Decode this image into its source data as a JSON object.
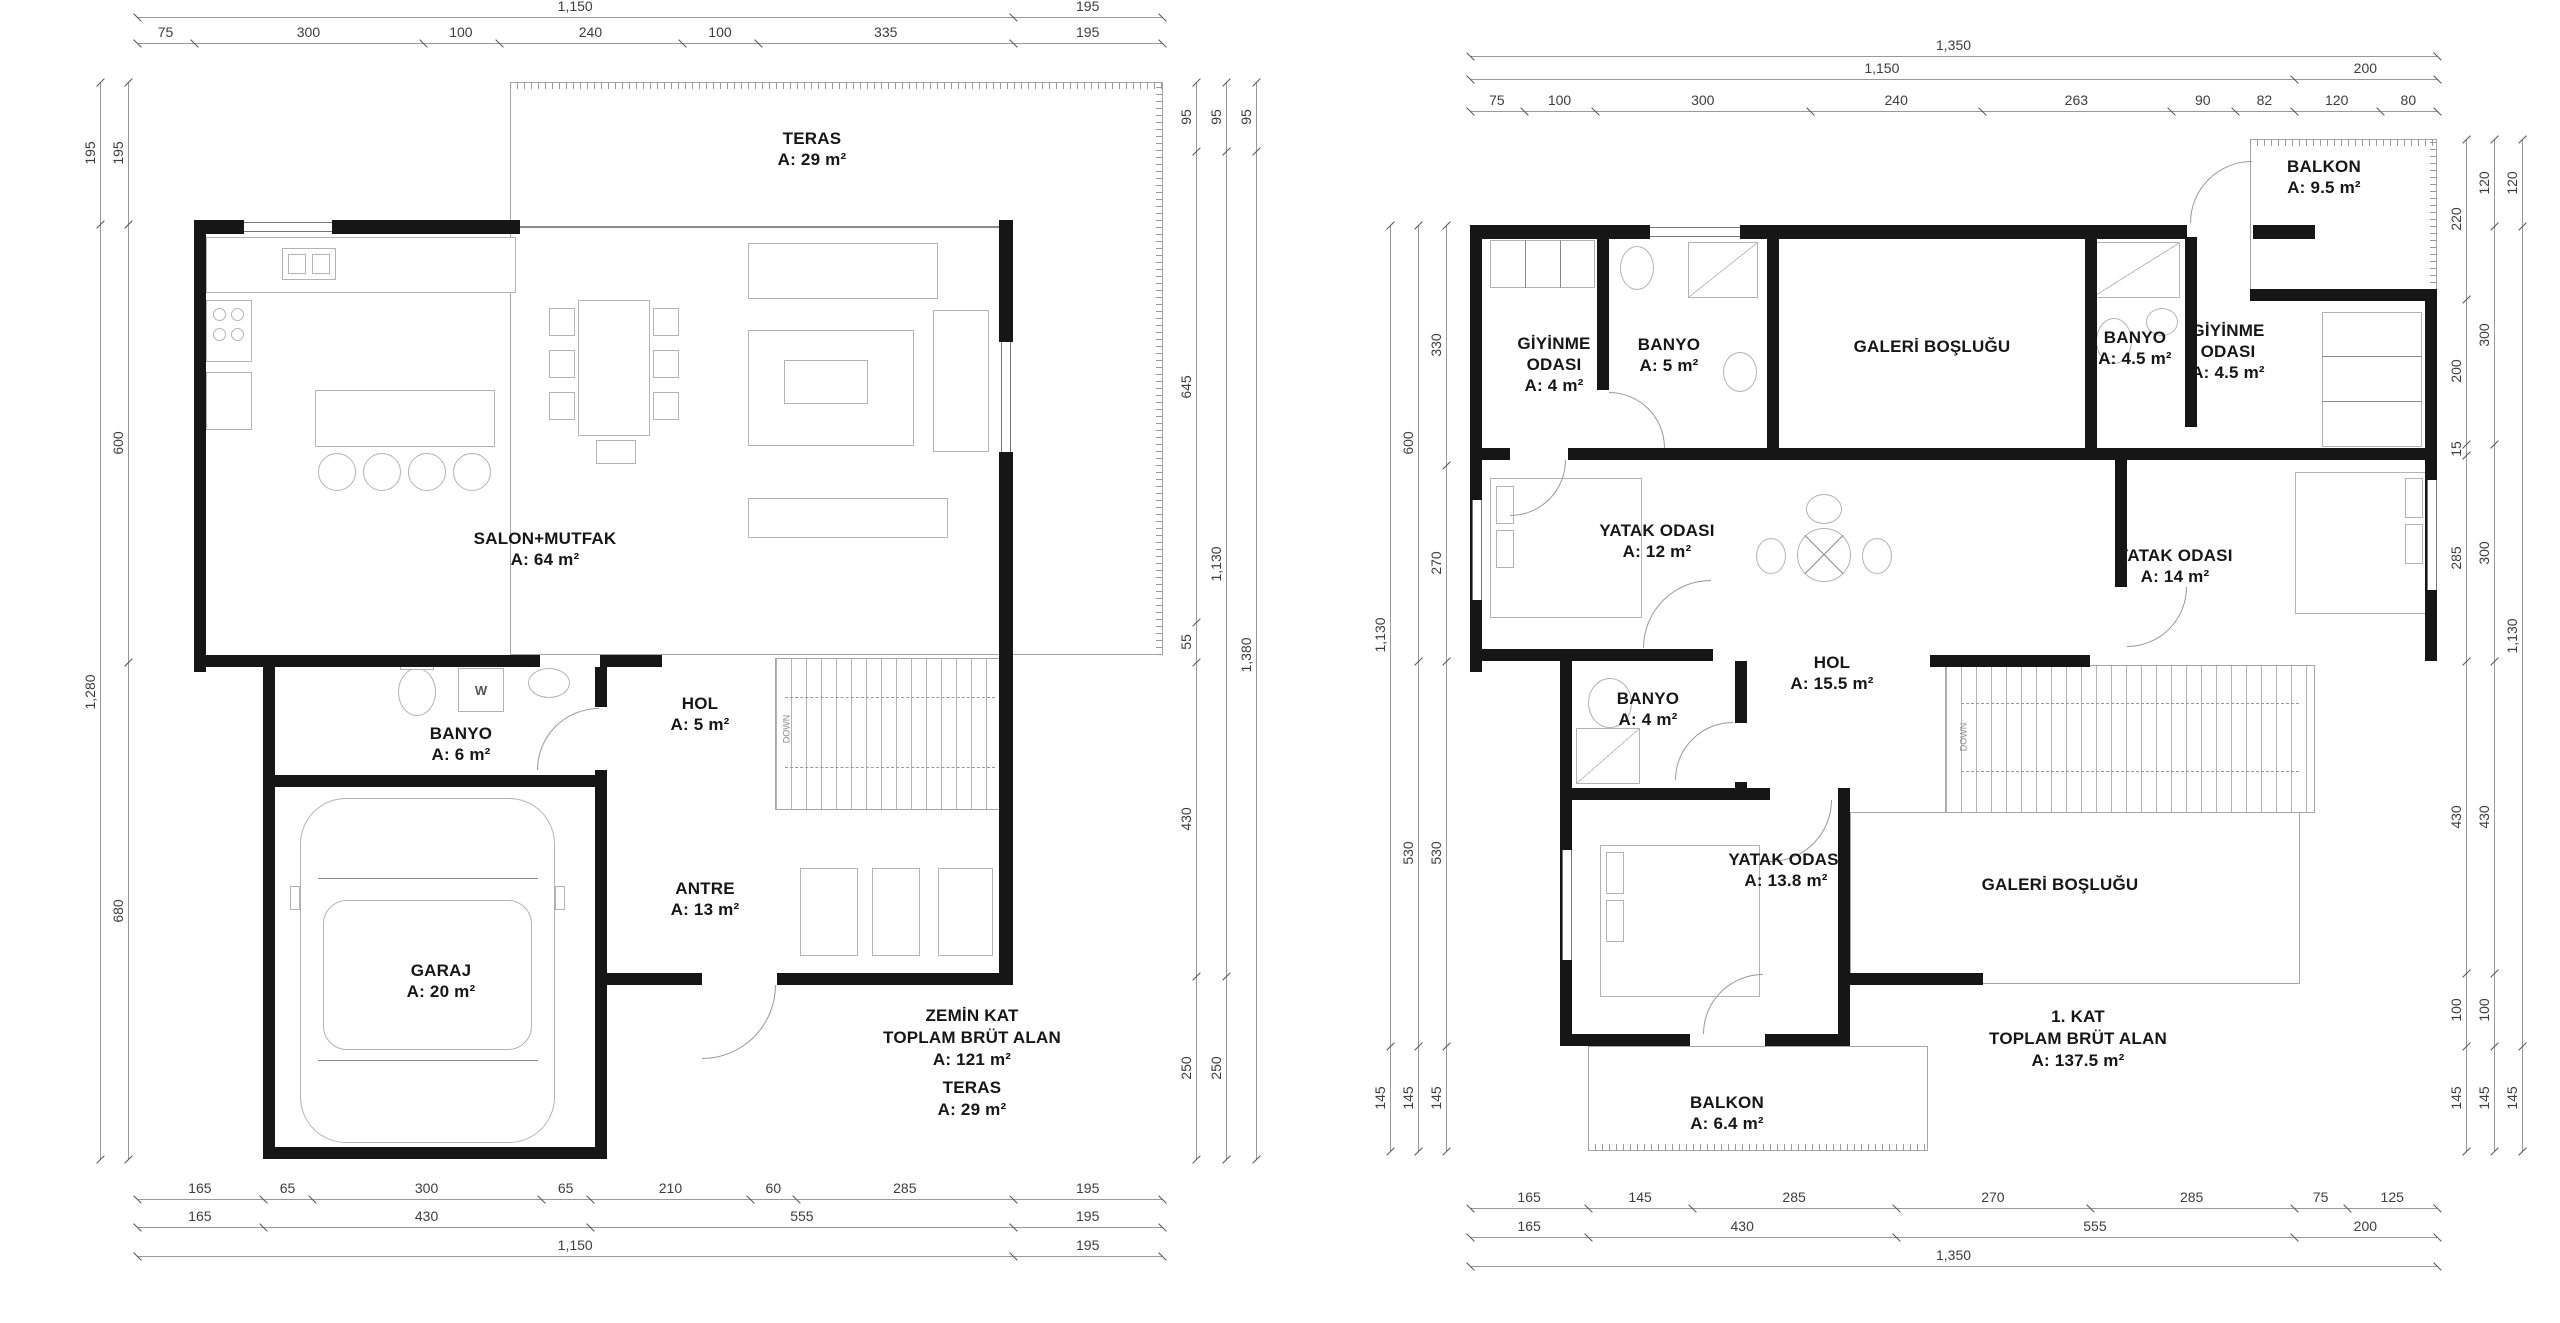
{
  "colors": {
    "background": "#ffffff",
    "wall": "#161616",
    "dim_text": "#3d3d3d",
    "thin_line": "#a6a6a6",
    "furniture_line": "#b3b3b3"
  },
  "plans": [
    {
      "id": "zemin-kat",
      "title_block": {
        "lines": [
          "ZEMİN KAT",
          "TOPLAM BRÜT ALAN",
          "A: 121 m²"
        ],
        "teras_lines": [
          "TERAS",
          "A: 29 m²"
        ]
      },
      "fixtures": {
        "washer_label": "W",
        "stair_label": "DOWN"
      },
      "rooms": [
        {
          "id": "teras",
          "lines": [
            "TERAS",
            "A: 29 m²"
          ]
        },
        {
          "id": "salon-mutfak",
          "lines": [
            "SALON+MUTFAK",
            "A: 64 m²"
          ]
        },
        {
          "id": "banyo",
          "lines": [
            "BANYO",
            "A: 6 m²"
          ]
        },
        {
          "id": "hol",
          "lines": [
            "HOL",
            "A: 5 m²"
          ]
        },
        {
          "id": "antre",
          "lines": [
            "ANTRE",
            "A: 13 m²"
          ]
        },
        {
          "id": "garaj",
          "lines": [
            "GARAJ",
            "A: 20 m²"
          ]
        }
      ],
      "dims": {
        "top": [
          [
            "1,150",
            "195"
          ],
          [
            "75",
            "300",
            "100",
            "240",
            "100",
            "335",
            "195"
          ]
        ],
        "bottom": [
          [
            "165",
            "65",
            "300",
            "65",
            "210",
            "60",
            "285",
            "195"
          ],
          [
            "165",
            "430",
            "555",
            "195"
          ],
          [
            "1,150",
            "195"
          ]
        ],
        "left": [
          [
            "195",
            "1,280"
          ],
          [
            "195",
            "600",
            "680"
          ]
        ],
        "right": [
          [
            "95",
            "645",
            "55",
            "430",
            "250"
          ],
          [
            "95",
            "1,130",
            "250"
          ],
          [
            "95",
            "1,380"
          ]
        ]
      }
    },
    {
      "id": "birinci-kat",
      "title_block": {
        "lines": [
          "1. KAT",
          "TOPLAM BRÜT ALAN",
          "A: 137.5 m²"
        ]
      },
      "fixtures": {
        "stair_label": "DOWN"
      },
      "rooms": [
        {
          "id": "balkon-ust",
          "lines": [
            "BALKON",
            "A: 9.5 m²"
          ]
        },
        {
          "id": "giyinme-odasi-sol",
          "lines": [
            "GİYİNME",
            "ODASI",
            "A: 4 m²"
          ]
        },
        {
          "id": "banyo-sol",
          "lines": [
            "BANYO",
            "A: 5 m²"
          ]
        },
        {
          "id": "galeri-boslugu-ust",
          "lines": [
            "GALERİ BOŞLUĞU"
          ]
        },
        {
          "id": "banyo-sag",
          "lines": [
            "BANYO",
            "A: 4.5 m²"
          ]
        },
        {
          "id": "giyinme-odasi-sag",
          "lines": [
            "GİYİNME",
            "ODASI",
            "A: 4.5 m²"
          ]
        },
        {
          "id": "yatak-odasi-sol",
          "lines": [
            "YATAK ODASI",
            "A: 12 m²"
          ]
        },
        {
          "id": "yatak-odasi-sag",
          "lines": [
            "YATAK ODASI",
            "A: 14 m²"
          ]
        },
        {
          "id": "hol",
          "lines": [
            "HOL",
            "A: 15.5 m²"
          ]
        },
        {
          "id": "banyo-orta",
          "lines": [
            "BANYO",
            "A: 4 m²"
          ]
        },
        {
          "id": "yatak-odasi-alt",
          "lines": [
            "YATAK ODASI",
            "A: 13.8 m²"
          ]
        },
        {
          "id": "galeri-boslugu-alt",
          "lines": [
            "GALERİ BOŞLUĞU"
          ]
        },
        {
          "id": "balkon-alt",
          "lines": [
            "BALKON",
            "A: 6.4 m²"
          ]
        }
      ],
      "dims": {
        "top": [
          [
            "1,350"
          ],
          [
            "1,150",
            "200"
          ],
          [
            "75",
            "100",
            "300",
            "240",
            "263",
            "90",
            "82",
            "120",
            "80"
          ]
        ],
        "bottom": [
          [
            "165",
            "145",
            "285",
            "270",
            "285",
            "75",
            "125"
          ],
          [
            "165",
            "430",
            "555",
            "200"
          ],
          [
            "1,350"
          ]
        ],
        "left": [
          [
            "1,130",
            "145"
          ],
          [
            "600",
            "530",
            "145"
          ],
          [
            "330",
            "270",
            "530",
            "145"
          ]
        ],
        "right": [
          [
            "220",
            "200",
            "15",
            "285",
            "430",
            "100",
            "145"
          ],
          [
            "120",
            "300",
            "300",
            "430",
            "100",
            "145"
          ],
          [
            "120",
            "1,130",
            "145"
          ]
        ]
      }
    }
  ]
}
